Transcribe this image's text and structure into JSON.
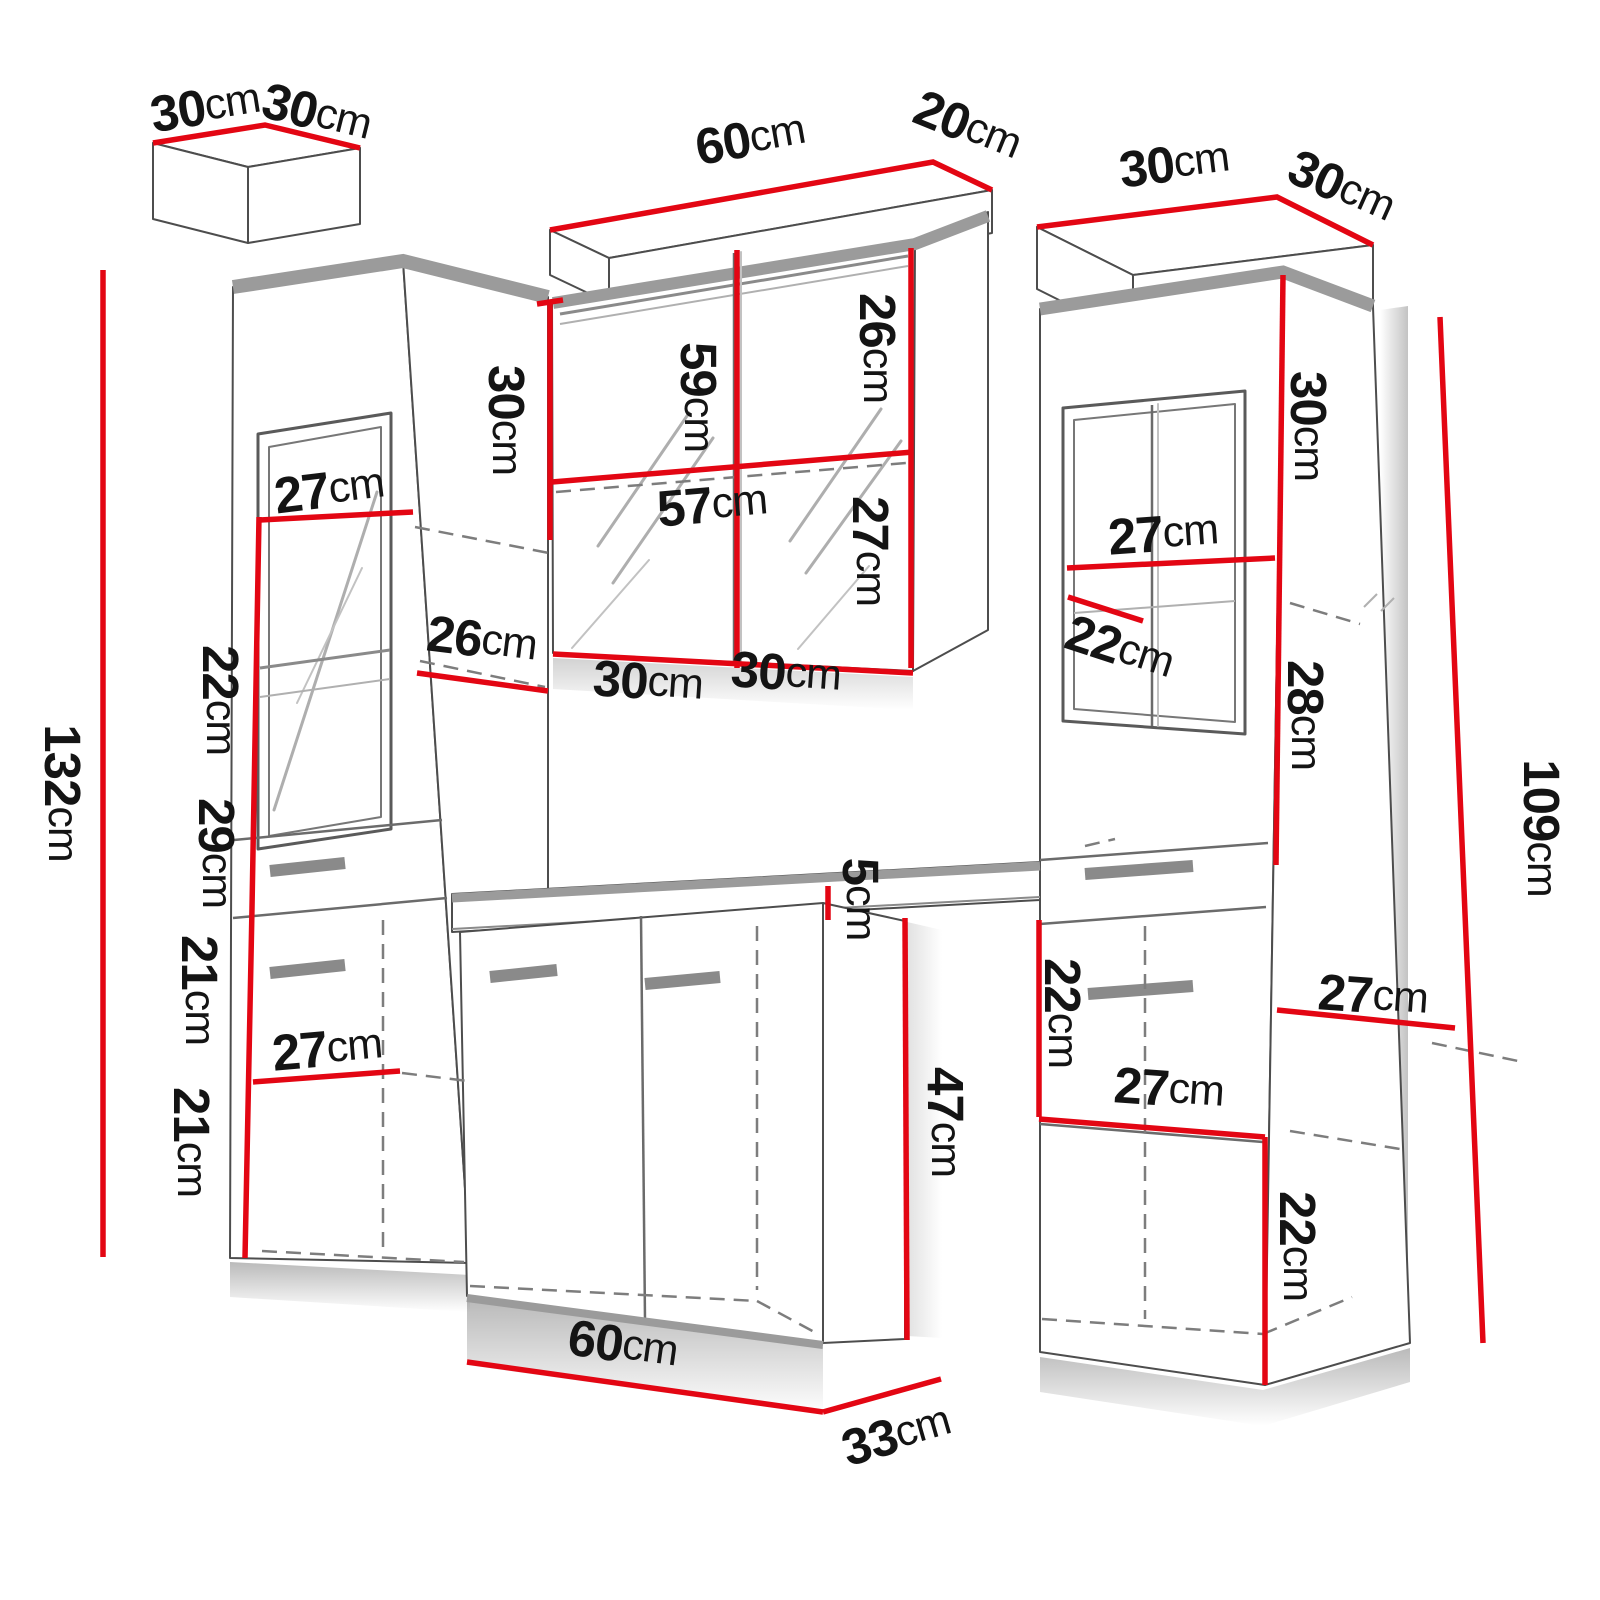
{
  "diagram_type": "furniture-dimension-diagram",
  "unit": "cm",
  "colors": {
    "background": "#ffffff",
    "dimension_line": "#e30613",
    "label_text": "#141414",
    "outline": "#4d4d4d",
    "cornice_band": "#9b9b9b"
  },
  "dimension_labels": [
    {
      "group": "left-cabinet-top",
      "text": "30cm",
      "value_cm": 30,
      "x": 205,
      "y": 106,
      "rotate": -9
    },
    {
      "group": "left-cabinet-top",
      "text": "30cm",
      "value_cm": 30,
      "x": 317,
      "y": 112,
      "rotate": 14
    },
    {
      "group": "mirror-cabinet-top",
      "text": "60cm",
      "value_cm": 60,
      "x": 750,
      "y": 138,
      "rotate": -10
    },
    {
      "group": "mirror-cabinet-top",
      "text": "20cm",
      "value_cm": 20,
      "x": 968,
      "y": 125,
      "rotate": 22
    },
    {
      "group": "right-cabinet-top",
      "text": "30cm",
      "value_cm": 30,
      "x": 1174,
      "y": 163,
      "rotate": -7
    },
    {
      "group": "right-cabinet-top",
      "text": "30cm",
      "value_cm": 30,
      "x": 1342,
      "y": 186,
      "rotate": 24
    },
    {
      "group": "left-cabinet",
      "text": "132cm",
      "value_cm": 132,
      "x": 63,
      "y": 793,
      "rotate": 90
    },
    {
      "group": "left-cabinet",
      "text": "27cm",
      "value_cm": 27,
      "x": 329,
      "y": 489,
      "rotate": -7
    },
    {
      "group": "left-cabinet",
      "text": "22cm",
      "value_cm": 22,
      "x": 221,
      "y": 700,
      "rotate": 90
    },
    {
      "group": "left-cabinet",
      "text": "29cm",
      "value_cm": 29,
      "x": 217,
      "y": 853,
      "rotate": 90
    },
    {
      "group": "left-cabinet",
      "text": "21cm",
      "value_cm": 21,
      "x": 200,
      "y": 990,
      "rotate": 90
    },
    {
      "group": "left-cabinet",
      "text": "21cm",
      "value_cm": 21,
      "x": 192,
      "y": 1142,
      "rotate": 90
    },
    {
      "group": "left-cabinet",
      "text": "27cm",
      "value_cm": 27,
      "x": 327,
      "y": 1048,
      "rotate": -5
    },
    {
      "group": "left-cabinet",
      "text": "26cm",
      "value_cm": 26,
      "x": 482,
      "y": 639,
      "rotate": 7
    },
    {
      "group": "mirror-cabinet",
      "text": "30cm",
      "value_cm": 30,
      "x": 507,
      "y": 420,
      "rotate": 90
    },
    {
      "group": "mirror-cabinet",
      "text": "59cm",
      "value_cm": 59,
      "x": 699,
      "y": 397,
      "rotate": 90
    },
    {
      "group": "mirror-cabinet",
      "text": "26cm",
      "value_cm": 26,
      "x": 878,
      "y": 348,
      "rotate": 90
    },
    {
      "group": "mirror-cabinet",
      "text": "57cm",
      "value_cm": 57,
      "x": 712,
      "y": 504,
      "rotate": -5
    },
    {
      "group": "mirror-cabinet",
      "text": "27cm",
      "value_cm": 27,
      "x": 871,
      "y": 551,
      "rotate": 90
    },
    {
      "group": "mirror-cabinet",
      "text": "30cm",
      "value_cm": 30,
      "x": 648,
      "y": 681,
      "rotate": 4
    },
    {
      "group": "mirror-cabinet",
      "text": "30cm",
      "value_cm": 30,
      "x": 786,
      "y": 672,
      "rotate": 4
    },
    {
      "group": "washbasin-cabinet",
      "text": "5cm",
      "value_cm": 5,
      "x": 861,
      "y": 899,
      "rotate": 90
    },
    {
      "group": "washbasin-cabinet",
      "text": "47cm",
      "value_cm": 47,
      "x": 946,
      "y": 1122,
      "rotate": 90
    },
    {
      "group": "washbasin-cabinet",
      "text": "60cm",
      "value_cm": 60,
      "x": 623,
      "y": 1344,
      "rotate": 8
    },
    {
      "group": "washbasin-cabinet",
      "text": "33cm",
      "value_cm": 33,
      "x": 896,
      "y": 1434,
      "rotate": -16
    },
    {
      "group": "right-cabinet",
      "text": "30cm",
      "value_cm": 30,
      "x": 1309,
      "y": 426,
      "rotate": 90
    },
    {
      "group": "right-cabinet",
      "text": "27cm",
      "value_cm": 27,
      "x": 1163,
      "y": 533,
      "rotate": -4
    },
    {
      "group": "right-cabinet",
      "text": "22cm",
      "value_cm": 22,
      "x": 1120,
      "y": 647,
      "rotate": 18
    },
    {
      "group": "right-cabinet",
      "text": "28cm",
      "value_cm": 28,
      "x": 1306,
      "y": 715,
      "rotate": 90
    },
    {
      "group": "right-cabinet",
      "text": "109cm",
      "value_cm": 109,
      "x": 1542,
      "y": 828,
      "rotate": 90
    },
    {
      "group": "right-cabinet",
      "text": "22cm",
      "value_cm": 22,
      "x": 1063,
      "y": 1013,
      "rotate": 90
    },
    {
      "group": "right-cabinet",
      "text": "27cm",
      "value_cm": 27,
      "x": 1373,
      "y": 995,
      "rotate": 4
    },
    {
      "group": "right-cabinet",
      "text": "27cm",
      "value_cm": 27,
      "x": 1169,
      "y": 1088,
      "rotate": 4
    },
    {
      "group": "right-cabinet",
      "text": "22cm",
      "value_cm": 22,
      "x": 1298,
      "y": 1246,
      "rotate": 90
    }
  ]
}
